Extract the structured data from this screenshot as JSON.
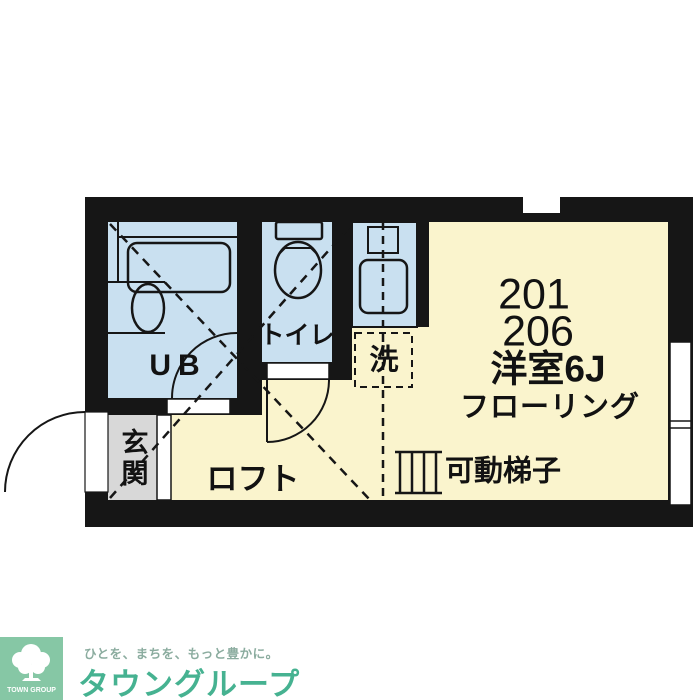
{
  "floor_plan": {
    "unit_no_1": "201",
    "unit_no_2": "206",
    "room_type": "洋室6J",
    "flooring": "フローリング",
    "bath_label": "UB",
    "toilet_label": "トイレ",
    "laundry_label": "洗",
    "entrance_label": "玄関",
    "loft_label": "ロフト",
    "ladder_label": "可動梯子",
    "colors": {
      "wall": "#161616",
      "floor": "#FAF4CD",
      "wet_area": "#C9E0F0",
      "entrance_floor": "#D8D8D8"
    }
  },
  "branding": {
    "tagline": "ひとを、まちを、もっと豊かに。",
    "company_name": "タウングループ",
    "logo_text": "TOWN GROUP",
    "colors": {
      "logo_green": "#46B291",
      "logo_square_green": "#86C7A5",
      "tagline_green": "#8BAC9F"
    }
  }
}
